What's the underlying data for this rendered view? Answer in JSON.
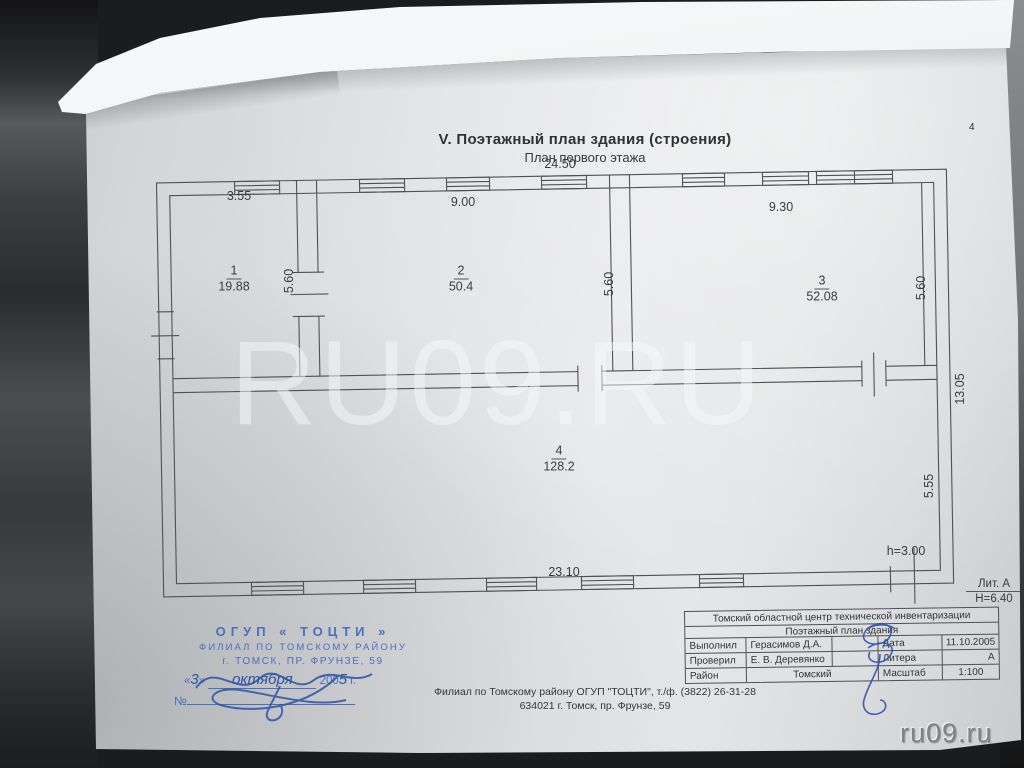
{
  "photo": {
    "page_number": "4",
    "watermark_center": "RU09.RU",
    "watermark_corner": "ru09.ru"
  },
  "document": {
    "section_title": "V.  Поэтажный план здания (строения)",
    "subtitle": "План первого этажа"
  },
  "plan": {
    "rooms": [
      {
        "number": "1",
        "area": "19.88"
      },
      {
        "number": "2",
        "area": "50.4"
      },
      {
        "number": "3",
        "area": "52.08"
      },
      {
        "number": "4",
        "area": "128.2"
      }
    ],
    "dims": {
      "top_total": "24.50",
      "room1_width": "3.55",
      "room2_width": "9.00",
      "room3_width": "9.30",
      "room1_depth": "5.60",
      "room2_depth": "5.60",
      "room3_depth": "5.60",
      "right_total": "13.05",
      "room4_depth": "5.55",
      "bottom_partial": "23.10",
      "ceiling_height": "h=3.00",
      "litera": "Лит. А",
      "building_height": "Н=6.40"
    }
  },
  "stamp": {
    "line1": "ОГУП  « ТОЦТИ »",
    "line2": "ФИЛИАЛ ПО ТОМСКОМУ РАЙОНУ",
    "line3": "г. ТОМСК,  ПР. ФРУНЗЕ,  59",
    "date_open": "«",
    "date_day": "3",
    "date_close": "»",
    "date_month": "октября",
    "date_year_prefix": "200",
    "date_year_digit": "5",
    "date_suffix": "г.",
    "number_label": "№"
  },
  "title_block": {
    "org": "Томский областной центр технической инвентаризации",
    "doc_type": "Поэтажный план здания",
    "made_label": "Выполнил",
    "made_value": "Герасимов Д.А.",
    "date_label": "Дата",
    "date_value": "11.10.2005",
    "checked_label": "Проверил",
    "checked_value": "Е. В. Деревянко",
    "litera_label": "Литера",
    "litera_value": "А",
    "district_label": "Район",
    "district_value": "Томский",
    "scale_label": "Масштаб",
    "scale_value": "1:100"
  },
  "footer": {
    "line1": "Филиал по Томскому району ОГУП \"ТОЦТИ\", т./ф. (3822) 26-31-28",
    "line2": "634021 г. Томск, пр. Фрунзе, 59"
  }
}
